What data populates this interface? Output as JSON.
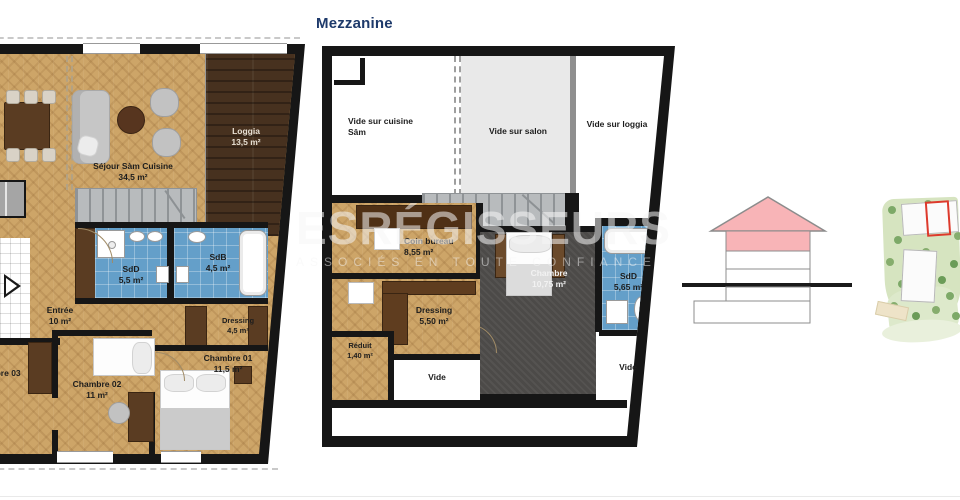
{
  "page": {
    "title_mezzanine": "Mezzanine",
    "watermark_line1": "ESRÉGISSEURS",
    "watermark_line2": "ASSOCIÉS EN TOUTE CONFIANCE"
  },
  "ground": {
    "sejour": {
      "name": "Séjour Sàm Cuisine",
      "area": "34,5 m²"
    },
    "loggia": {
      "name": "Loggia",
      "area": "13,5 m²"
    },
    "sdd": {
      "name": "SdD",
      "area": "5,5 m²"
    },
    "sdb": {
      "name": "SdB",
      "area": "4,5 m²"
    },
    "entree": {
      "name": "Entrée",
      "area": "10 m²"
    },
    "dressing": {
      "name": "Dressing",
      "area": "4,5 m²"
    },
    "chambre01": {
      "name": "Chambre 01",
      "area": "11,5 m²"
    },
    "chambre02": {
      "name": "Chambre 02",
      "area": "11 m²"
    },
    "chambre03": {
      "name": "Chambre 03"
    },
    "door_label": "V.21"
  },
  "mezzanine": {
    "vide_cuisine": {
      "name": "Vide sur cuisine",
      "name2": "Sâm"
    },
    "vide_salon": {
      "name": "Vide sur salon"
    },
    "vide_loggia": {
      "name": "Vide sur loggia"
    },
    "coin_bureau": {
      "name": "Coin bureau",
      "area": "8,55 m²"
    },
    "chambre": {
      "name": "Chambre",
      "area": "10,75 m²"
    },
    "sdd": {
      "name": "SdD",
      "area": "5,65 m²"
    },
    "dressing": {
      "name": "Dressing",
      "area": "5,50 m²"
    },
    "reduit": {
      "name": "Réduit",
      "area": "1,40 m²"
    },
    "vide1": {
      "name": "Vide"
    },
    "vide2": {
      "name": "Vide"
    }
  },
  "colors": {
    "accent_navy": "#1e3a6b",
    "roof_pink": "#f8b4b7",
    "site_highlight_red": "#dd3a2c",
    "parquet": "#cda568",
    "dark_wood": "#47311f",
    "tile_blue": "#649fc9"
  }
}
